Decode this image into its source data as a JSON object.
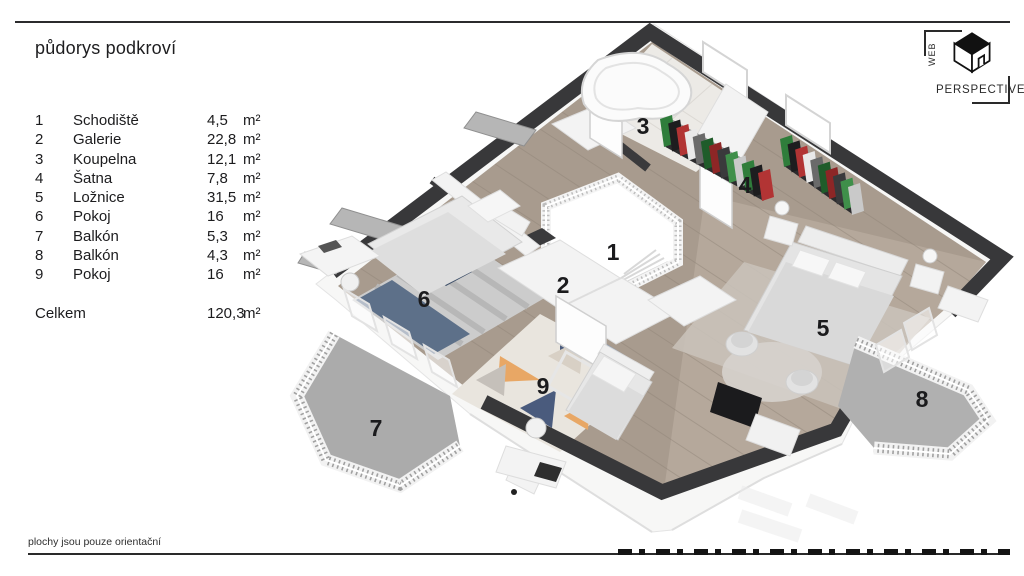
{
  "title": "půdorys podkroví",
  "legend": {
    "rows": [
      {
        "num": "1",
        "name": "Schodiště",
        "value": "4,5",
        "unit": "m²"
      },
      {
        "num": "2",
        "name": "Galerie",
        "value": "22,8",
        "unit": "m²"
      },
      {
        "num": "3",
        "name": "Koupelna",
        "value": "12,1",
        "unit": "m²"
      },
      {
        "num": "4",
        "name": "Šatna",
        "value": "7,8",
        "unit": "m²"
      },
      {
        "num": "5",
        "name": "Ložnice",
        "value": "31,5",
        "unit": "m²"
      },
      {
        "num": "6",
        "name": "Pokoj",
        "value": "16",
        "unit": "m²"
      },
      {
        "num": "7",
        "name": "Balkón",
        "value": "5,3",
        "unit": "m²"
      },
      {
        "num": "8",
        "name": "Balkón",
        "value": "4,3",
        "unit": "m²"
      },
      {
        "num": "9",
        "name": "Pokoj",
        "value": "16",
        "unit": "m²"
      }
    ],
    "total": {
      "label": "Celkem",
      "value": "120,3",
      "unit": "m²"
    }
  },
  "footnote": "plochy jsou pouze orientační",
  "logo": {
    "word_vertical": "WEB",
    "word_horizontal": "PERSPECTIVE"
  },
  "plan": {
    "room_labels": [
      {
        "num": "1",
        "x": 613,
        "y": 260
      },
      {
        "num": "2",
        "x": 563,
        "y": 293
      },
      {
        "num": "3",
        "x": 643,
        "y": 134
      },
      {
        "num": "4",
        "x": 745,
        "y": 193
      },
      {
        "num": "5",
        "x": 823,
        "y": 336
      },
      {
        "num": "6",
        "x": 424,
        "y": 307
      },
      {
        "num": "7",
        "x": 376,
        "y": 436
      },
      {
        "num": "8",
        "x": 922,
        "y": 407
      },
      {
        "num": "9",
        "x": 543,
        "y": 394
      }
    ],
    "racks": [
      {
        "x1": 668,
        "y1": 134,
        "x2": 766,
        "y2": 188,
        "count": 13
      },
      {
        "x1": 788,
        "y1": 154,
        "x2": 856,
        "y2": 202,
        "count": 10
      }
    ],
    "palette": {
      "wall_dark": "#38383a",
      "floor_wood": "#a89b8e",
      "floor_wood_light": "#b5a89b",
      "floor_tile": "#eceae6",
      "balcony_floor": "#ababab",
      "clothes": [
        "#2f7d3b",
        "#1d1d1f",
        "#b23434",
        "#e9e9e9",
        "#6a6a6a",
        "#1f5c2a",
        "#8d2626",
        "#3a3a3c",
        "#3f8f4a",
        "#c9c9c9"
      ],
      "rug_navy": "#4a5b7d",
      "rug_steel": "#93a3b8",
      "rug_orange": "#e8a765",
      "rug_salmon": "#df7f5e"
    }
  }
}
